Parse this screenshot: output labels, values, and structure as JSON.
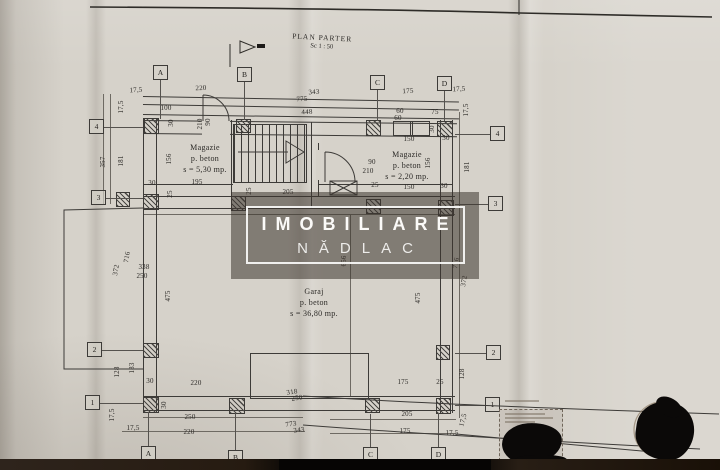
{
  "sheet": {
    "title": "PLAN PARTER",
    "scale": "Sc 1 : 50"
  },
  "watermark": {
    "line1": "IMOBILIARE",
    "line2": "NĂDLAC"
  },
  "rooms": [
    {
      "name": "Magazie",
      "material": "p. beton",
      "area": "s = 5,30 mp.",
      "x": 205,
      "y": 143
    },
    {
      "name": "Magazie",
      "material": "p. beton",
      "area": "s = 2,20 mp.",
      "x": 407,
      "y": 150
    },
    {
      "name": "Garaj",
      "material": "p. beton",
      "area": "s = 36,80 mp.",
      "x": 314,
      "y": 287
    }
  ],
  "grid_bubbles": [
    {
      "t": "A",
      "x": 160,
      "y": 72
    },
    {
      "t": "B",
      "x": 244,
      "y": 74
    },
    {
      "t": "C",
      "x": 377,
      "y": 82
    },
    {
      "t": "D",
      "x": 444,
      "y": 83
    },
    {
      "t": "A",
      "x": 148,
      "y": 453
    },
    {
      "t": "B",
      "x": 235,
      "y": 457
    },
    {
      "t": "C",
      "x": 370,
      "y": 454
    },
    {
      "t": "D",
      "x": 438,
      "y": 454
    },
    {
      "t": "4",
      "x": 96,
      "y": 126
    },
    {
      "t": "3",
      "x": 98,
      "y": 197
    },
    {
      "t": "2",
      "x": 94,
      "y": 349
    },
    {
      "t": "1",
      "x": 92,
      "y": 402
    },
    {
      "t": "4",
      "x": 497,
      "y": 133
    },
    {
      "t": "3",
      "x": 495,
      "y": 203
    },
    {
      "t": "2",
      "x": 493,
      "y": 352
    },
    {
      "t": "1",
      "x": 492,
      "y": 404
    }
  ],
  "dims": [
    {
      "t": "17,5",
      "x": 136,
      "y": 90,
      "r": -3
    },
    {
      "t": "220",
      "x": 201,
      "y": 88,
      "r": -2
    },
    {
      "t": "343",
      "x": 314,
      "y": 92,
      "r": -4
    },
    {
      "t": "775",
      "x": 302,
      "y": 99,
      "r": -4
    },
    {
      "t": "175",
      "x": 408,
      "y": 91,
      "r": -3
    },
    {
      "t": "17,5",
      "x": 459,
      "y": 89,
      "r": -3
    },
    {
      "t": "100",
      "x": 166,
      "y": 108,
      "r": 0
    },
    {
      "t": "448",
      "x": 307,
      "y": 112,
      "r": -3
    },
    {
      "t": "60",
      "x": 400,
      "y": 111,
      "r": 0
    },
    {
      "t": "60",
      "x": 398,
      "y": 118,
      "r": 0
    },
    {
      "t": "75",
      "x": 435,
      "y": 112,
      "r": 0
    },
    {
      "t": "30",
      "x": 432,
      "y": 129,
      "r": -90
    },
    {
      "t": "150",
      "x": 409,
      "y": 139,
      "r": 0
    },
    {
      "t": "30",
      "x": 446,
      "y": 138,
      "r": 0
    },
    {
      "t": "17,5",
      "x": 466,
      "y": 110,
      "r": -90
    },
    {
      "t": "17,5",
      "x": 121,
      "y": 107,
      "r": -90
    },
    {
      "t": "30",
      "x": 171,
      "y": 123,
      "r": -90
    },
    {
      "t": "90",
      "x": 208,
      "y": 122,
      "r": -90
    },
    {
      "t": "210",
      "x": 200,
      "y": 124,
      "r": -90
    },
    {
      "t": "357",
      "x": 103,
      "y": 162,
      "r": -90
    },
    {
      "t": "181",
      "x": 121,
      "y": 161,
      "r": -90
    },
    {
      "t": "156",
      "x": 169,
      "y": 159,
      "r": -90
    },
    {
      "t": "30",
      "x": 152,
      "y": 183,
      "r": 0
    },
    {
      "t": "195",
      "x": 197,
      "y": 182,
      "r": 0
    },
    {
      "t": "25",
      "x": 170,
      "y": 194,
      "r": -90
    },
    {
      "t": "25",
      "x": 249,
      "y": 191,
      "r": -90
    },
    {
      "t": "205",
      "x": 288,
      "y": 192,
      "r": 0
    },
    {
      "t": "90",
      "x": 372,
      "y": 162,
      "r": 0
    },
    {
      "t": "210",
      "x": 368,
      "y": 171,
      "r": 0
    },
    {
      "t": "156",
      "x": 428,
      "y": 163,
      "r": -90
    },
    {
      "t": "181",
      "x": 467,
      "y": 167,
      "r": -90
    },
    {
      "t": "25",
      "x": 375,
      "y": 185,
      "r": 0
    },
    {
      "t": "150",
      "x": 409,
      "y": 187,
      "r": 0
    },
    {
      "t": "30",
      "x": 444,
      "y": 186,
      "r": 0
    },
    {
      "t": "716",
      "x": 127,
      "y": 257,
      "r": -80
    },
    {
      "t": "372",
      "x": 116,
      "y": 270,
      "r": -80
    },
    {
      "t": "338",
      "x": 144,
      "y": 267,
      "r": 0
    },
    {
      "t": "250",
      "x": 142,
      "y": 276,
      "r": 0
    },
    {
      "t": "475",
      "x": 168,
      "y": 296,
      "r": -90
    },
    {
      "t": "656",
      "x": 344,
      "y": 261,
      "r": -90
    },
    {
      "t": "716",
      "x": 456,
      "y": 263,
      "r": -80
    },
    {
      "t": "372",
      "x": 464,
      "y": 281,
      "r": -80
    },
    {
      "t": "475",
      "x": 418,
      "y": 298,
      "r": -90
    },
    {
      "t": "128",
      "x": 117,
      "y": 372,
      "r": -90
    },
    {
      "t": "183",
      "x": 132,
      "y": 368,
      "r": -90
    },
    {
      "t": "128",
      "x": 462,
      "y": 374,
      "r": -90
    },
    {
      "t": "30",
      "x": 150,
      "y": 381,
      "r": 0
    },
    {
      "t": "220",
      "x": 196,
      "y": 383,
      "r": 0
    },
    {
      "t": "175",
      "x": 403,
      "y": 382,
      "r": 0
    },
    {
      "t": "25",
      "x": 440,
      "y": 382,
      "r": 0
    },
    {
      "t": "30",
      "x": 164,
      "y": 405,
      "r": -90
    },
    {
      "t": "250",
      "x": 190,
      "y": 417,
      "r": 0
    },
    {
      "t": "205",
      "x": 407,
      "y": 414,
      "r": 0
    },
    {
      "t": "17,5",
      "x": 112,
      "y": 415,
      "r": -90
    },
    {
      "t": "17,5",
      "x": 133,
      "y": 428,
      "r": 0
    },
    {
      "t": "220",
      "x": 189,
      "y": 432,
      "r": 0
    },
    {
      "t": "175",
      "x": 405,
      "y": 431,
      "r": 0
    },
    {
      "t": "17,5",
      "x": 452,
      "y": 433,
      "r": 0
    },
    {
      "t": "17,5",
      "x": 463,
      "y": 420,
      "r": -75
    },
    {
      "t": "318",
      "x": 292,
      "y": 392,
      "r": -8
    },
    {
      "t": "250",
      "x": 297,
      "y": 398,
      "r": -8
    },
    {
      "t": "773",
      "x": 291,
      "y": 424,
      "r": -8
    },
    {
      "t": "343",
      "x": 299,
      "y": 430,
      "r": -8
    }
  ],
  "colors": {
    "paper": "#d6d2ca",
    "ink": "#3d3b38",
    "watermark_text": "#fbfaf8",
    "blob": "#0b0908"
  }
}
